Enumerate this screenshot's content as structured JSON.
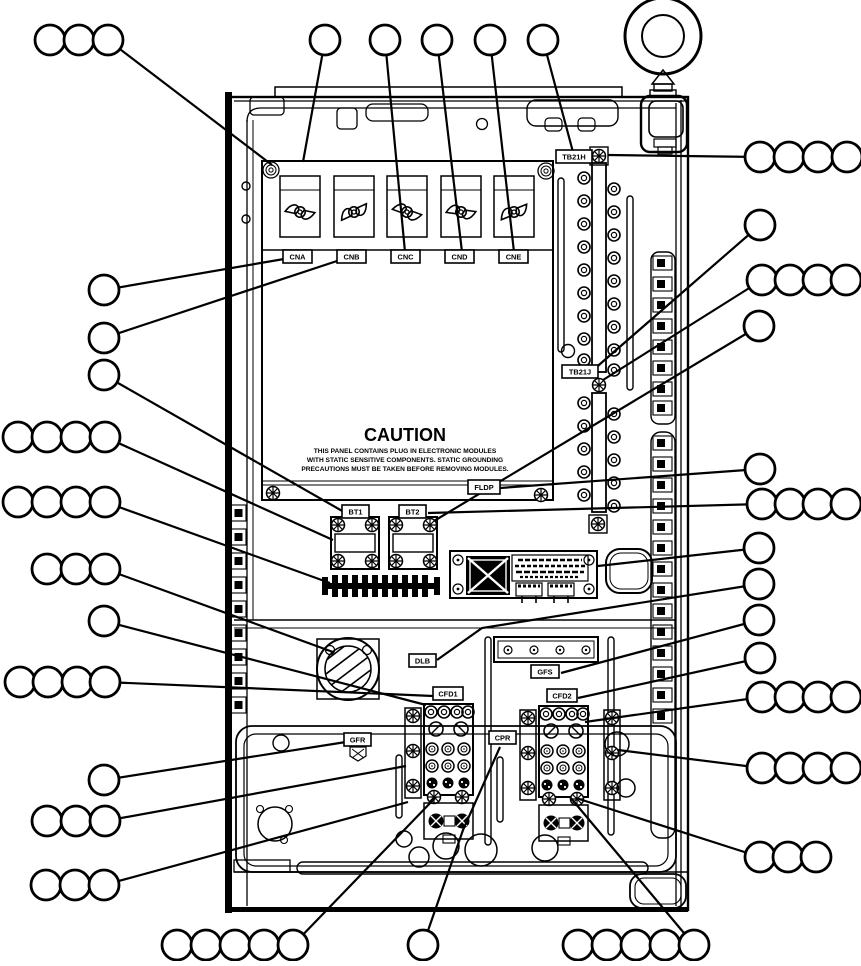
{
  "caution": {
    "title": "CAUTION",
    "line1": "THIS PANEL CONTAINS PLUG IN ELECTRONIC MODULES",
    "line2": "WITH STATIC SENSITIVE COMPONENTS.  STATIC GROUNDING",
    "line3": "PRECAUTIONS MUST BE TAKEN BEFORE REMOVING MODULES."
  },
  "colors": {
    "line": "#000000",
    "background": "#ffffff"
  },
  "labels": [
    {
      "id": "cna",
      "text": "CNA",
      "x": 283,
      "y": 250,
      "w": 29,
      "h": 13
    },
    {
      "id": "cnb",
      "text": "CNB",
      "x": 337,
      "y": 250,
      "w": 29,
      "h": 13
    },
    {
      "id": "cnc",
      "text": "CNC",
      "x": 391,
      "y": 250,
      "w": 29,
      "h": 13
    },
    {
      "id": "cnd",
      "text": "CND",
      "x": 445,
      "y": 250,
      "w": 29,
      "h": 13
    },
    {
      "id": "cne",
      "text": "CNE",
      "x": 499,
      "y": 250,
      "w": 29,
      "h": 13
    },
    {
      "id": "tb21h",
      "text": "TB21H",
      "x": 556,
      "y": 150,
      "w": 36,
      "h": 13
    },
    {
      "id": "tb21j",
      "text": "TB21J",
      "x": 562,
      "y": 365,
      "w": 36,
      "h": 13
    },
    {
      "id": "fldp",
      "text": "FLDP",
      "x": 468,
      "y": 480,
      "w": 32,
      "h": 14
    },
    {
      "id": "bt1",
      "text": "BT1",
      "x": 342,
      "y": 505,
      "w": 27,
      "h": 13
    },
    {
      "id": "bt2",
      "text": "BT2",
      "x": 399,
      "y": 505,
      "w": 27,
      "h": 13
    },
    {
      "id": "dlb",
      "text": "DLB",
      "x": 409,
      "y": 654,
      "w": 27,
      "h": 13
    },
    {
      "id": "gfs",
      "text": "GFS",
      "x": 531,
      "y": 665,
      "w": 28,
      "h": 13
    },
    {
      "id": "cfd1",
      "text": "CFD1",
      "x": 433,
      "y": 687,
      "w": 30,
      "h": 13
    },
    {
      "id": "cfd2",
      "text": "CFD2",
      "x": 547,
      "y": 689,
      "w": 30,
      "h": 13
    },
    {
      "id": "gfr",
      "text": "GFR",
      "x": 344,
      "y": 733,
      "w": 27,
      "h": 13
    },
    {
      "id": "cpr",
      "text": "CPR",
      "x": 489,
      "y": 731,
      "w": 27,
      "h": 13
    }
  ],
  "callouts": [
    {
      "id": "top-left-group",
      "circles": [
        [
          50,
          40
        ],
        [
          79,
          40
        ],
        [
          108,
          40
        ]
      ],
      "leader": [
        [
          108,
          40
        ],
        [
          272,
          165
        ]
      ]
    },
    {
      "id": "top-1",
      "circles": [
        [
          325,
          40
        ]
      ],
      "leader": [
        [
          325,
          40
        ],
        [
          303,
          162
        ]
      ]
    },
    {
      "id": "top-2",
      "circles": [
        [
          385,
          40
        ]
      ],
      "leader": [
        [
          385,
          40
        ],
        [
          405,
          252
        ]
      ]
    },
    {
      "id": "top-3",
      "circles": [
        [
          437,
          40
        ]
      ],
      "leader": [
        [
          437,
          40
        ],
        [
          462,
          252
        ]
      ]
    },
    {
      "id": "top-4",
      "circles": [
        [
          490,
          40
        ]
      ],
      "leader": [
        [
          490,
          40
        ],
        [
          514,
          252
        ]
      ]
    },
    {
      "id": "top-5",
      "circles": [
        [
          543,
          40
        ]
      ],
      "leader": [
        [
          543,
          40
        ],
        [
          573,
          152
        ]
      ]
    },
    {
      "id": "left-1",
      "circles": [
        [
          104,
          290
        ]
      ],
      "leader": [
        [
          104,
          290
        ],
        [
          284,
          259
        ]
      ]
    },
    {
      "id": "left-2",
      "circles": [
        [
          104,
          338
        ]
      ],
      "leader": [
        [
          104,
          338
        ],
        [
          340,
          260
        ]
      ]
    },
    {
      "id": "left-3",
      "circles": [
        [
          104,
          375
        ]
      ],
      "leader": [
        [
          104,
          375
        ],
        [
          344,
          512
        ]
      ]
    },
    {
      "id": "left-row-a",
      "circles": [
        [
          18,
          437
        ],
        [
          47,
          437
        ],
        [
          76,
          437
        ],
        [
          105,
          437
        ]
      ],
      "leader": [
        [
          105,
          437
        ],
        [
          333,
          540
        ]
      ]
    },
    {
      "id": "left-row-b",
      "circles": [
        [
          18,
          502
        ],
        [
          47,
          502
        ],
        [
          76,
          502
        ],
        [
          105,
          502
        ]
      ],
      "leader": [
        [
          105,
          502
        ],
        [
          330,
          583
        ]
      ]
    },
    {
      "id": "left-row-c",
      "circles": [
        [
          47,
          569
        ],
        [
          76,
          569
        ],
        [
          105,
          569
        ]
      ],
      "leader": [
        [
          105,
          569
        ],
        [
          333,
          652
        ]
      ]
    },
    {
      "id": "left-4",
      "circles": [
        [
          104,
          621
        ]
      ],
      "leader": [
        [
          104,
          621
        ],
        [
          426,
          705
        ]
      ]
    },
    {
      "id": "left-row-d",
      "circles": [
        [
          20,
          682
        ],
        [
          48,
          682
        ],
        [
          77,
          682
        ],
        [
          105,
          682
        ]
      ],
      "leader": [
        [
          105,
          682
        ],
        [
          433,
          696
        ]
      ]
    },
    {
      "id": "left-5",
      "circles": [
        [
          104,
          780
        ]
      ],
      "leader": [
        [
          104,
          780
        ],
        [
          346,
          742
        ]
      ]
    },
    {
      "id": "left-row-e",
      "circles": [
        [
          47,
          821
        ],
        [
          76,
          821
        ],
        [
          105,
          821
        ]
      ],
      "leader": [
        [
          105,
          821
        ],
        [
          406,
          766
        ]
      ]
    },
    {
      "id": "left-row-f",
      "circles": [
        [
          46,
          885
        ],
        [
          75,
          885
        ],
        [
          104,
          885
        ]
      ],
      "leader": [
        [
          104,
          885
        ],
        [
          408,
          802
        ]
      ]
    },
    {
      "id": "bottom-left-group",
      "circles": [
        [
          177,
          945
        ],
        [
          206,
          945
        ],
        [
          235,
          945
        ],
        [
          264,
          945
        ],
        [
          293,
          945
        ]
      ],
      "leader": [
        [
          293,
          945
        ],
        [
          436,
          797
        ]
      ]
    },
    {
      "id": "bottom-center",
      "circles": [
        [
          423,
          945
        ]
      ],
      "leader": [
        [
          423,
          945
        ],
        [
          463,
          830
        ],
        [
          500,
          747
        ]
      ]
    },
    {
      "id": "bottom-right-group",
      "circles": [
        [
          578,
          945
        ],
        [
          607,
          945
        ],
        [
          636,
          945
        ],
        [
          665,
          945
        ],
        [
          694,
          945
        ]
      ],
      "leader": [
        [
          694,
          945
        ],
        [
          570,
          797
        ]
      ]
    },
    {
      "id": "right-row-a",
      "circles": [
        [
          760,
          157
        ],
        [
          789,
          157
        ],
        [
          818,
          157
        ],
        [
          847,
          157
        ]
      ],
      "leader": [
        [
          760,
          157
        ],
        [
          608,
          155
        ]
      ]
    },
    {
      "id": "right-1",
      "circles": [
        [
          760,
          225
        ]
      ],
      "leader": [
        [
          760,
          225
        ],
        [
          592,
          371
        ]
      ]
    },
    {
      "id": "right-row-b",
      "circles": [
        [
          762,
          280
        ],
        [
          790,
          280
        ],
        [
          818,
          280
        ],
        [
          846,
          280
        ]
      ],
      "leader": [
        [
          762,
          280
        ],
        [
          603,
          380
        ]
      ]
    },
    {
      "id": "right-2",
      "circles": [
        [
          759,
          326
        ]
      ],
      "leader": [
        [
          759,
          326
        ],
        [
          434,
          521
        ]
      ]
    },
    {
      "id": "right-3",
      "circles": [
        [
          760,
          469
        ]
      ],
      "leader": [
        [
          760,
          469
        ],
        [
          500,
          488
        ]
      ]
    },
    {
      "id": "right-row-c",
      "circles": [
        [
          762,
          504
        ],
        [
          790,
          504
        ],
        [
          818,
          504
        ],
        [
          846,
          504
        ]
      ],
      "leader": [
        [
          762,
          504
        ],
        [
          428,
          513
        ]
      ]
    },
    {
      "id": "right-4",
      "circles": [
        [
          759,
          548
        ]
      ],
      "leader": [
        [
          759,
          548
        ],
        [
          598,
          566
        ]
      ]
    },
    {
      "id": "right-5",
      "circles": [
        [
          759,
          584
        ]
      ],
      "leader": [
        [
          759,
          584
        ],
        [
          482,
          628
        ],
        [
          437,
          660
        ]
      ]
    },
    {
      "id": "right-6",
      "circles": [
        [
          759,
          620
        ]
      ],
      "leader": [
        [
          759,
          620
        ],
        [
          561,
          673
        ]
      ]
    },
    {
      "id": "right-7",
      "circles": [
        [
          760,
          658
        ]
      ],
      "leader": [
        [
          760,
          658
        ],
        [
          578,
          698
        ]
      ]
    },
    {
      "id": "right-row-d",
      "circles": [
        [
          762,
          697
        ],
        [
          790,
          697
        ],
        [
          818,
          697
        ],
        [
          846,
          697
        ]
      ],
      "leader": [
        [
          762,
          697
        ],
        [
          585,
          722
        ]
      ]
    },
    {
      "id": "right-row-e",
      "circles": [
        [
          762,
          768
        ],
        [
          790,
          768
        ],
        [
          818,
          768
        ],
        [
          846,
          768
        ]
      ],
      "leader": [
        [
          762,
          768
        ],
        [
          618,
          750
        ]
      ]
    },
    {
      "id": "right-row-f",
      "circles": [
        [
          760,
          857
        ],
        [
          788,
          857
        ],
        [
          816,
          857
        ]
      ],
      "leader": [
        [
          760,
          857
        ],
        [
          576,
          798
        ]
      ]
    }
  ]
}
